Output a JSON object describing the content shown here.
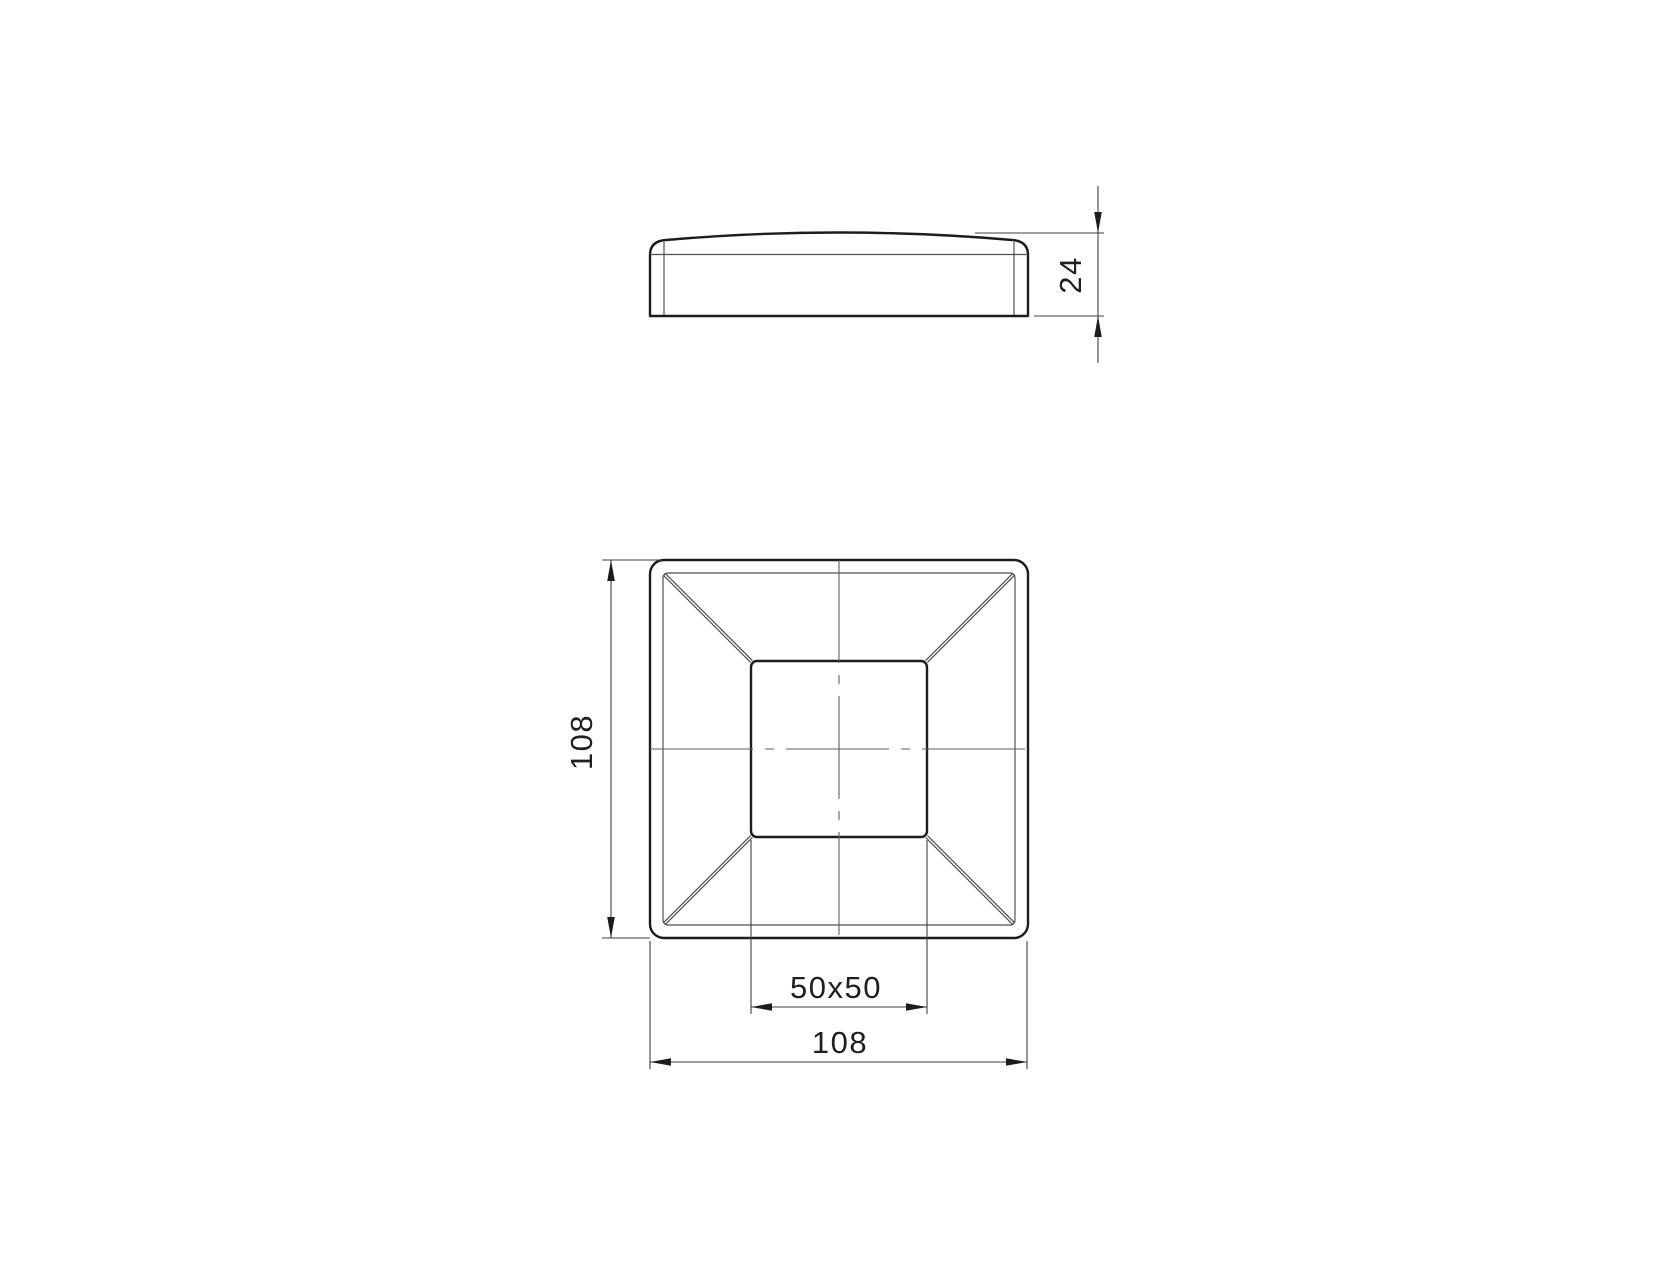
{
  "labels": {
    "cap_height": "24",
    "plan_height": "108",
    "plan_width": "108",
    "inner_square": "50x50"
  },
  "style": {
    "background": "#ffffff",
    "outline_color": "#1d1d1d",
    "thin_line_color": "#4f4f4f",
    "dimension_color": "#3f3f3f"
  }
}
